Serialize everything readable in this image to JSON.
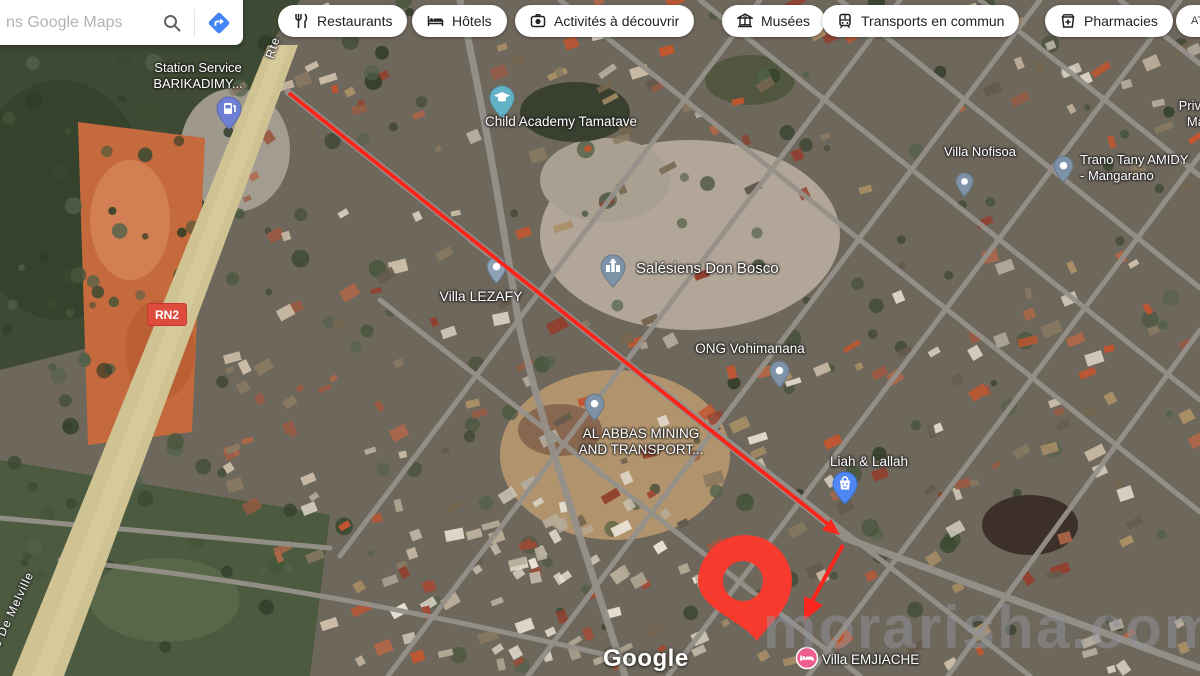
{
  "search": {
    "placeholder": "ns Google Maps"
  },
  "toolbar": {
    "chips": [
      {
        "label": "Restaurants",
        "icon": "restaurant-icon"
      },
      {
        "label": "Hôtels",
        "icon": "hotel-icon"
      },
      {
        "label": "Activités à découvrir",
        "icon": "camera-icon"
      },
      {
        "label": "Musées",
        "icon": "museum-icon"
      },
      {
        "label": "Transports en commun",
        "icon": "transit-icon"
      },
      {
        "label": "Pharmacies",
        "icon": "pharmacy-icon"
      }
    ],
    "partial_chip": "AT"
  },
  "pois": [
    {
      "id": "station-service",
      "lines": [
        "Station Service",
        "BARIKADIMY..."
      ],
      "pin": "fuel"
    },
    {
      "id": "child-academy",
      "name": "Child Academy Tamatave",
      "pin": "school"
    },
    {
      "id": "villa-nofisoa",
      "name": "Villa Nofisoa",
      "pin": "generic"
    },
    {
      "id": "private-school",
      "lines": [
        "Private S",
        "Mahat"
      ],
      "pin": "none"
    },
    {
      "id": "trano-tany",
      "lines": [
        "Trano Tany AMIDY",
        "- Mangarano"
      ],
      "pin": "generic"
    },
    {
      "id": "salesiens-don-bosco",
      "name": "Salésiens Don Bosco",
      "pin": "church"
    },
    {
      "id": "villa-lezafy",
      "name": "Villa LEZAFY",
      "pin": "generic"
    },
    {
      "id": "ong-vohimanana",
      "name": "ONG Vohimanana",
      "pin": "generic"
    },
    {
      "id": "al-abbas",
      "lines": [
        "AL ABBAS MINING",
        "AND TRANSPORT..."
      ],
      "pin": "generic"
    },
    {
      "id": "liah-lallah",
      "name": "Liah & Lallah",
      "pin": "shopping"
    },
    {
      "id": "villa-emjiache",
      "name": "Villa EMJIACHE",
      "pin": "lodging"
    }
  ],
  "road_labels": {
    "rn2": "RN2",
    "rte": "Rte",
    "melville": "Rte De Melville"
  },
  "watermark": "morarisha.com",
  "attribution": "Google",
  "colors": {
    "annotation_red": "#fa251b",
    "pin_red": "#f63b2e",
    "chip_text": "#202124",
    "directions_blue": "#4285f4",
    "rn2_badge": "#dd4b3c"
  }
}
